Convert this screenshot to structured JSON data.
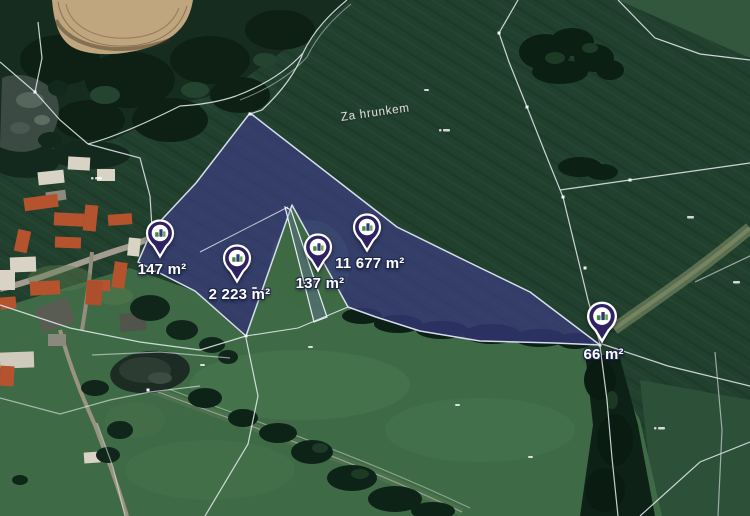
{
  "map": {
    "place_label": "Za hrunkem",
    "markers": [
      {
        "id": "parcel-147",
        "label": "147 m²"
      },
      {
        "id": "parcel-2223",
        "label": "2 223 m²"
      },
      {
        "id": "parcel-137",
        "label": "137 m²"
      },
      {
        "id": "parcel-11677",
        "label": "11 677 m²"
      },
      {
        "id": "parcel-66",
        "label": "66 m²"
      }
    ],
    "colors": {
      "parcel_highlight": "#3e3c8c",
      "parcel_outline": "#dde3f2",
      "pin_fill": "#2e2263",
      "pin_border": "#ffffff",
      "label_text": "#ffffff",
      "label_outline": "#20274a",
      "field_dark": "#22402e",
      "meadow_green": "#3e6b45",
      "tree_dark": "#0d2116",
      "soil_tan": "#c0a67e"
    }
  }
}
